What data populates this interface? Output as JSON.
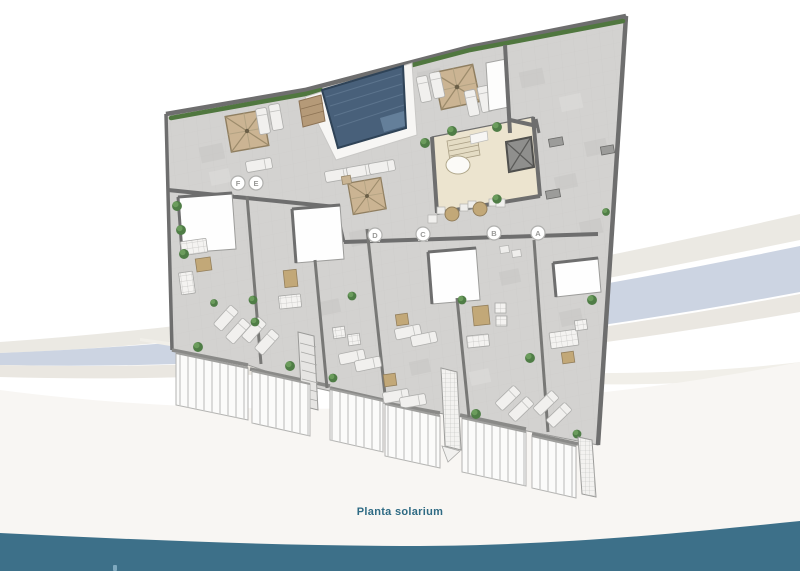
{
  "caption": {
    "text": "Planta solarium"
  },
  "markers": [
    {
      "label": "A"
    },
    {
      "label": "B"
    },
    {
      "label": "C"
    },
    {
      "label": "D"
    },
    {
      "label": "E"
    },
    {
      "label": "F"
    }
  ],
  "colors": {
    "brand_teal": "#3d7089",
    "caption_teal": "#2f6b84",
    "pool_water": "#48607a",
    "wave_blue": "#ccd4e2",
    "floor_gray": "#d3d2d0",
    "wall_gray": "#6e6e6e",
    "parasol_tan": "#cbb493",
    "plant_green": "#4f7d46",
    "covered_beige": "#ece4cf"
  }
}
